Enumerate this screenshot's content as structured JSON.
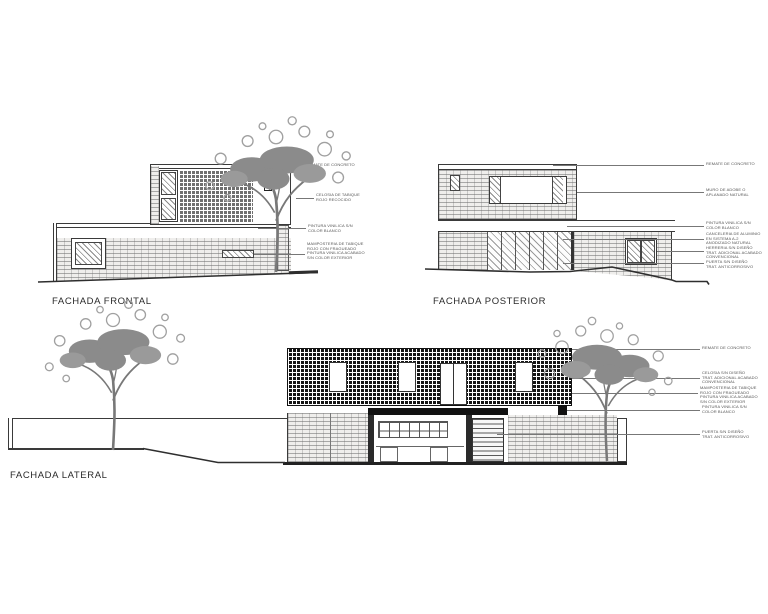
{
  "drawing": {
    "type": "architectural-elevations",
    "background": "#ffffff",
    "line_color": "#3a3a3a",
    "annotation_color": "#555555",
    "tree_color": "#8b8b8b"
  },
  "frontal": {
    "label": "FACHADA FRONTAL",
    "callouts": [
      {
        "text": "REMATE DE CONCRETO"
      },
      {
        "text": "CELOSIA DE TABIQUE\nROJO RECOCIDO"
      },
      {
        "text": "PINTURA VINILICA S/N\nCOLOR BLANCO"
      },
      {
        "text": "MAMPOSTERIA DE TABIQUE\nROJO CON FRAGUEADO\nPINTURA VINILICA ACABADO\nS/N COLOR EXTERIOR"
      }
    ]
  },
  "posterior": {
    "label": "FACHADA POSTERIOR",
    "callouts": [
      {
        "text": "REMATE DE CONCRETO"
      },
      {
        "text": "MURO DE ADOBE O\nAPLANADO NATURAL"
      },
      {
        "text": "PINTURA VINILICA S/N\nCOLOR BLANCO"
      },
      {
        "text": "CANCELERIA DE ALUMINIO\nEN SISTEMA A-2\nANODIZADO NATURAL"
      },
      {
        "text": "HERRERIA S/N DISEÑO\nTRAT. ADICIONAL ACABADO\nCONVENCIONAL"
      },
      {
        "text": "PUERTA S/N DISEÑO\nTRAT. ANTICORROSIVO"
      }
    ]
  },
  "lateral": {
    "label": "FACHADA LATERAL",
    "callouts": [
      {
        "text": "REMATE DE CONCRETO"
      },
      {
        "text": "CELOSIA S/N DISEÑO\nTRAT. ADICIONAL ACABADO\nCONVENCIONAL"
      },
      {
        "text": "MAMPOSTERIA DE TABIQUE\nROJO CON FRAGUEADO\nPINTURA VINILICA ACABADO\nS/N COLOR EXTERIOR"
      },
      {
        "text": "PINTURA VINILICA S/N\nCOLOR BLANCO"
      },
      {
        "text": "PUERTA S/N DISEÑO\nTRAT. ANTICORROSIVO"
      }
    ]
  }
}
